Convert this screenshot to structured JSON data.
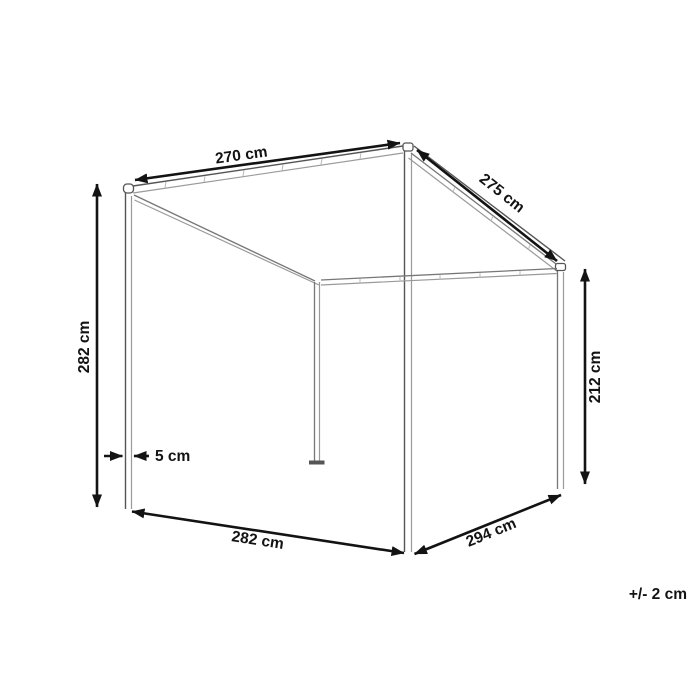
{
  "diagram": {
    "type": "product-dimension-drawing",
    "subject": "canopy-pergola-wireframe",
    "labels": {
      "top_front_width": "270 cm",
      "roof_slope_depth": "275 cm",
      "front_post_height": "282 cm",
      "back_post_height": "212 cm",
      "post_thickness": "5 cm",
      "bottom_front_width": "282 cm",
      "bottom_side_depth": "294 cm",
      "tolerance": "+/- 2 cm"
    },
    "colors": {
      "dimension_line": "#131313",
      "label_text": "#131313",
      "structure_dark": "#555555",
      "structure_light": "#9a9a9a",
      "background": "#ffffff"
    }
  }
}
